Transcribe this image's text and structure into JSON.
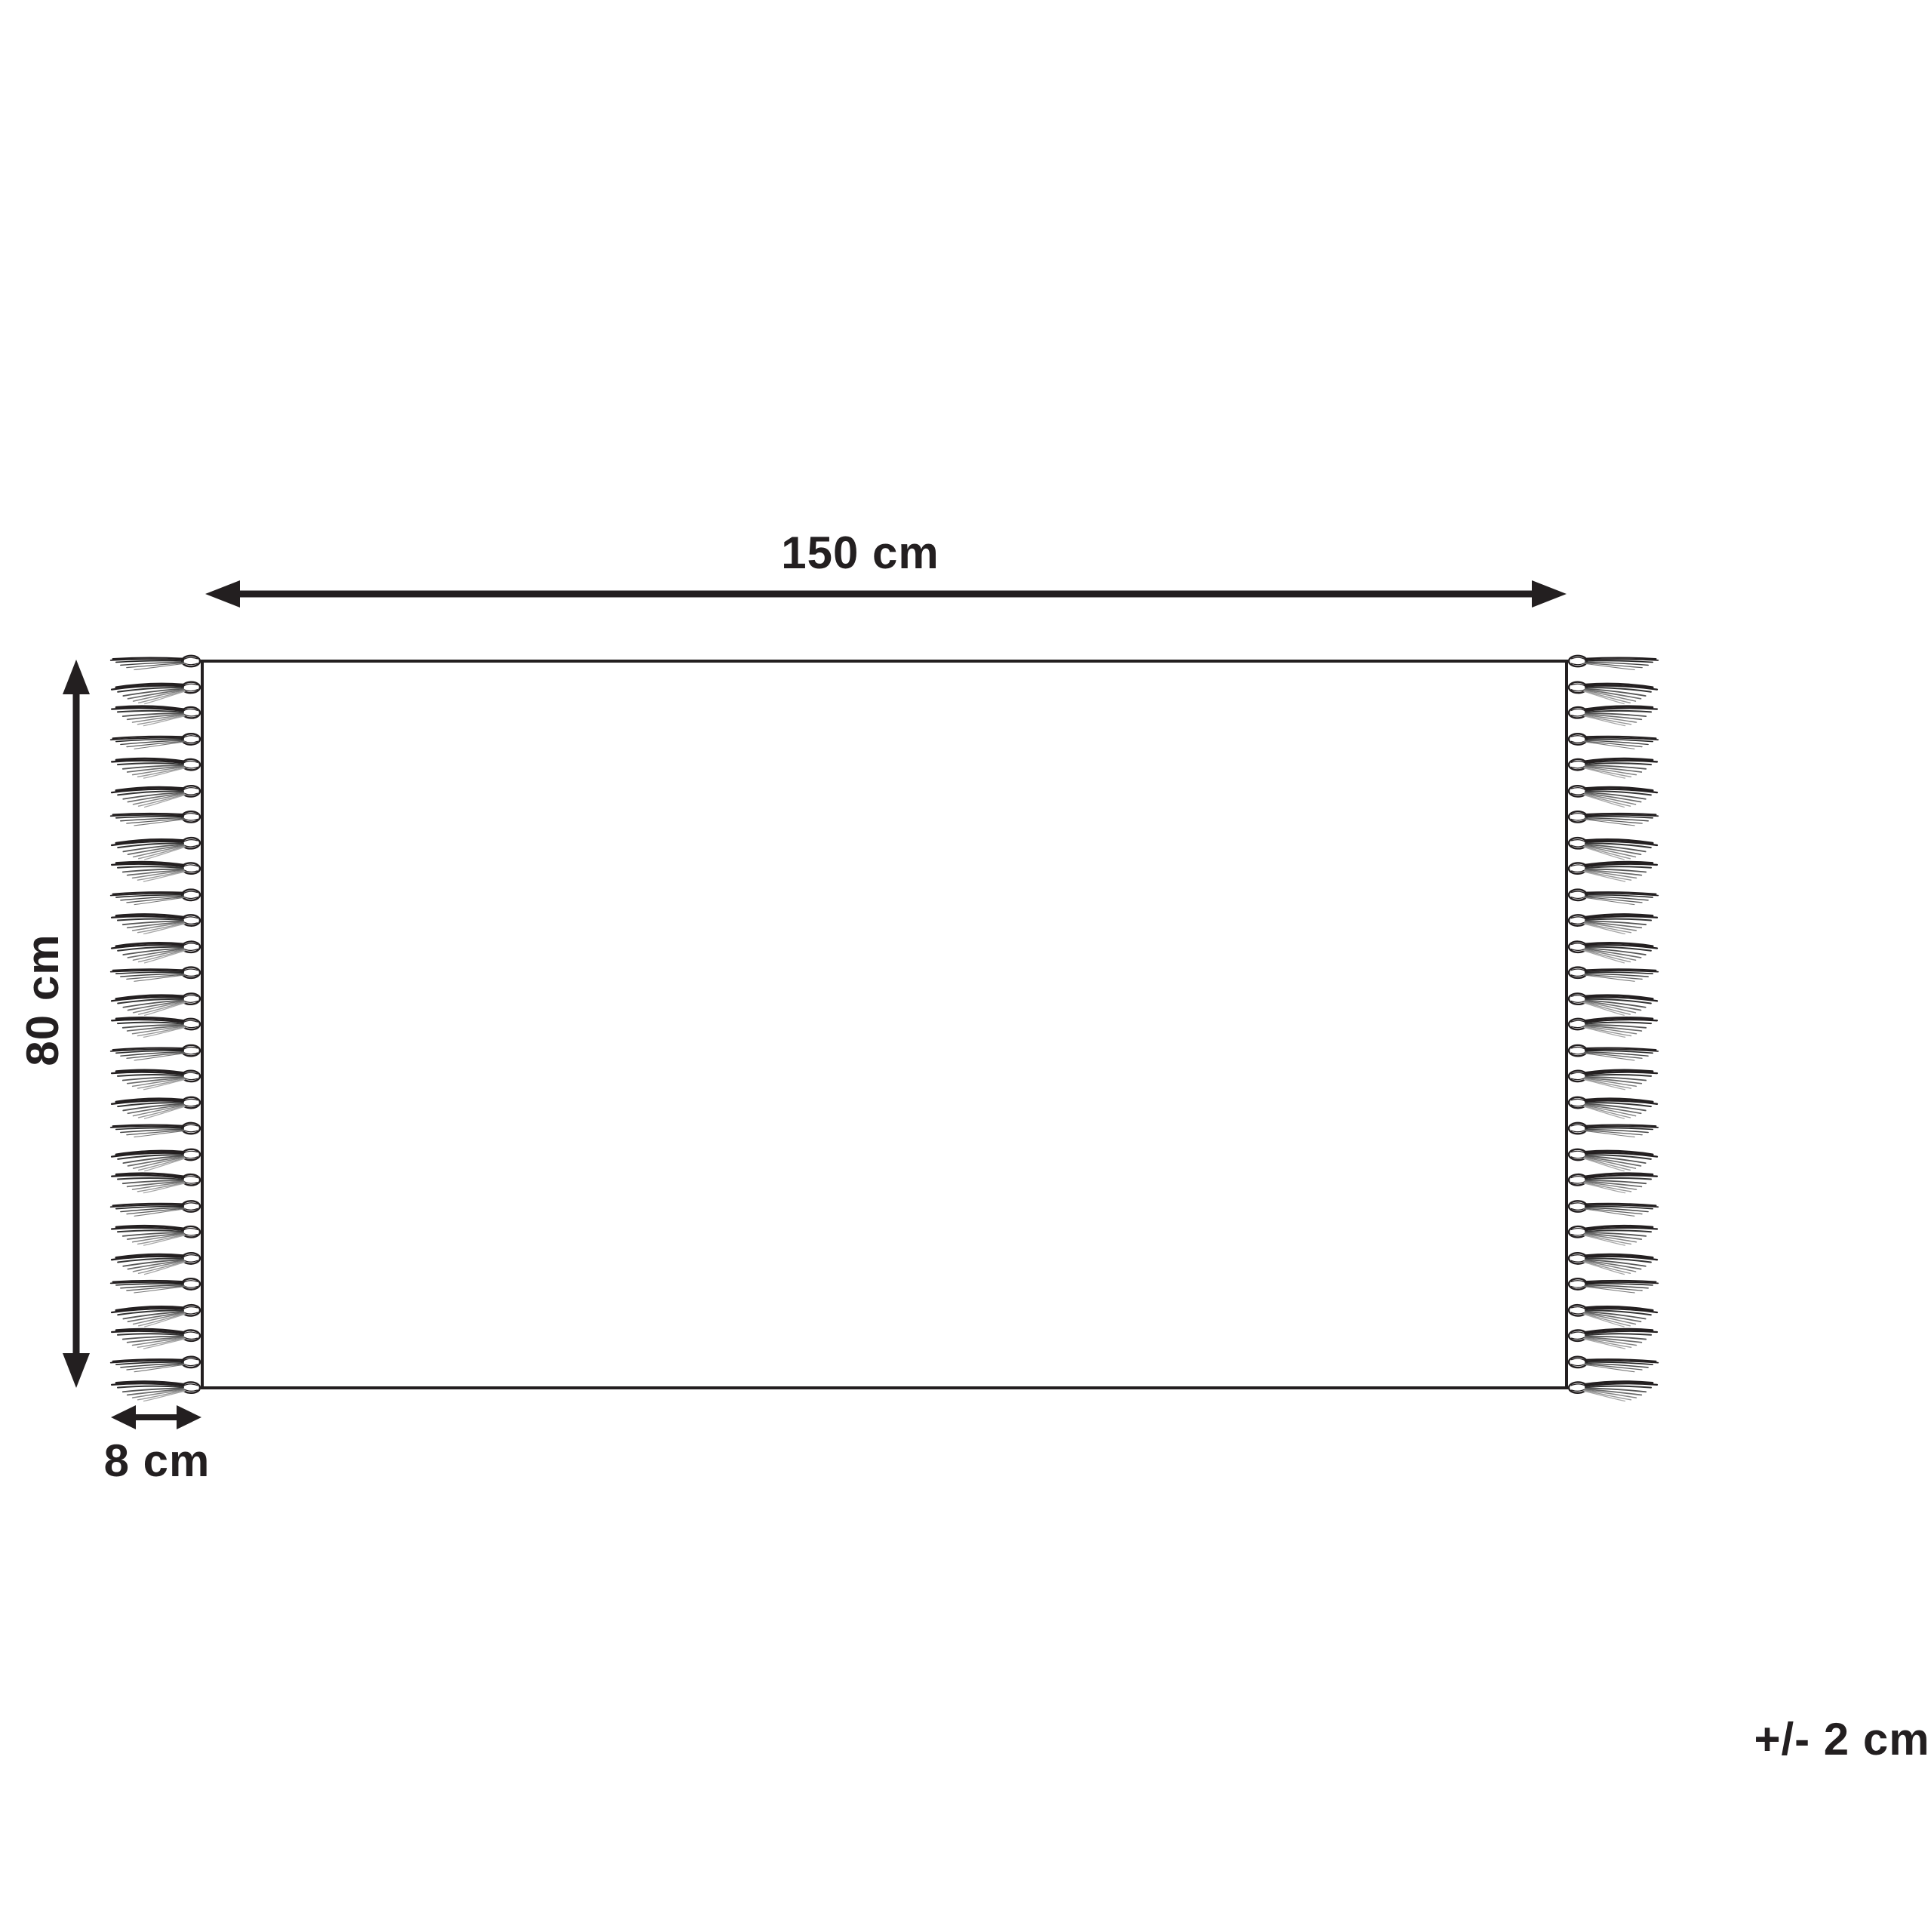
{
  "diagram": {
    "type": "rug-dimension-diagram",
    "labels": {
      "width": "150 cm",
      "height": "80 cm",
      "fringe": "8 cm",
      "tolerance": "+/- 2 cm"
    },
    "dimensions": {
      "width_cm": 150,
      "height_cm": 80,
      "fringe_cm": 8,
      "tolerance_cm": 2
    },
    "fringe": {
      "sides": [
        "left",
        "right"
      ],
      "tassels_per_side": 29
    },
    "colors": {
      "ink": "#231f20",
      "background": "#ffffff"
    }
  }
}
